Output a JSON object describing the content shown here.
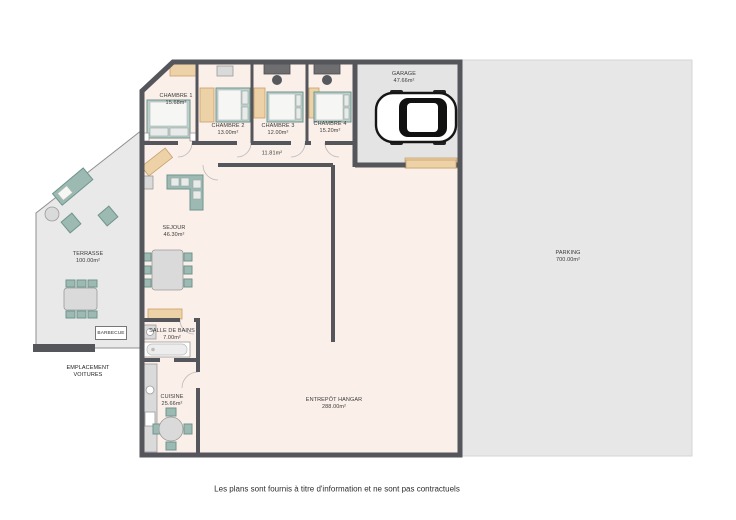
{
  "page": {
    "disclaimer": "Les plans sont fournis à titre d'information et ne sont pas contractuels"
  },
  "colors": {
    "pagebg": "#ffffff",
    "wall": "#55565b",
    "floor": "#fbefe9",
    "terrace": "#e9e9e9",
    "garagefloor": "#e4e4e4",
    "parking": "#e7e7e7",
    "teal": "#9cbab2",
    "tealdark": "#6f958d",
    "wood": "#eed2a7",
    "woodborder": "#c5a06c",
    "gray": "#dadada",
    "grayborder": "#9a9a9a"
  },
  "rooms": {
    "chambre1": {
      "name": "CHAMBRE 1",
      "area": "15.68m²"
    },
    "chambre2": {
      "name": "CHAMBRE 2",
      "area": "13.00m²"
    },
    "chambre3": {
      "name": "CHAMBRE 3",
      "area": "12.00m²"
    },
    "chambre4": {
      "name": "CHAMBRE 4",
      "area": "15.20m²"
    },
    "garage": {
      "name": "GARAGE",
      "area": "47.66m²"
    },
    "couloir": {
      "area": "11.81m²"
    },
    "sejour": {
      "name": "SEJOUR",
      "area": "46.30m²"
    },
    "terrasse": {
      "name": "TERRASSE",
      "area": "100.00m²"
    },
    "barbecue": {
      "name": "BARBECUE"
    },
    "emplacement_voitures": {
      "name": "EMPLACEMENT VOITURES"
    },
    "salle_de_bains": {
      "name": "SALLE DE BAINS",
      "area": "7.00m²"
    },
    "cuisine": {
      "name": "CUISINE",
      "area": "25.66m²"
    },
    "entrepot_hangar": {
      "name": "ENTREPÔT HANGAR",
      "area": "288.00m²"
    },
    "parking": {
      "name": "PARKING",
      "area": "700.00m²"
    }
  }
}
